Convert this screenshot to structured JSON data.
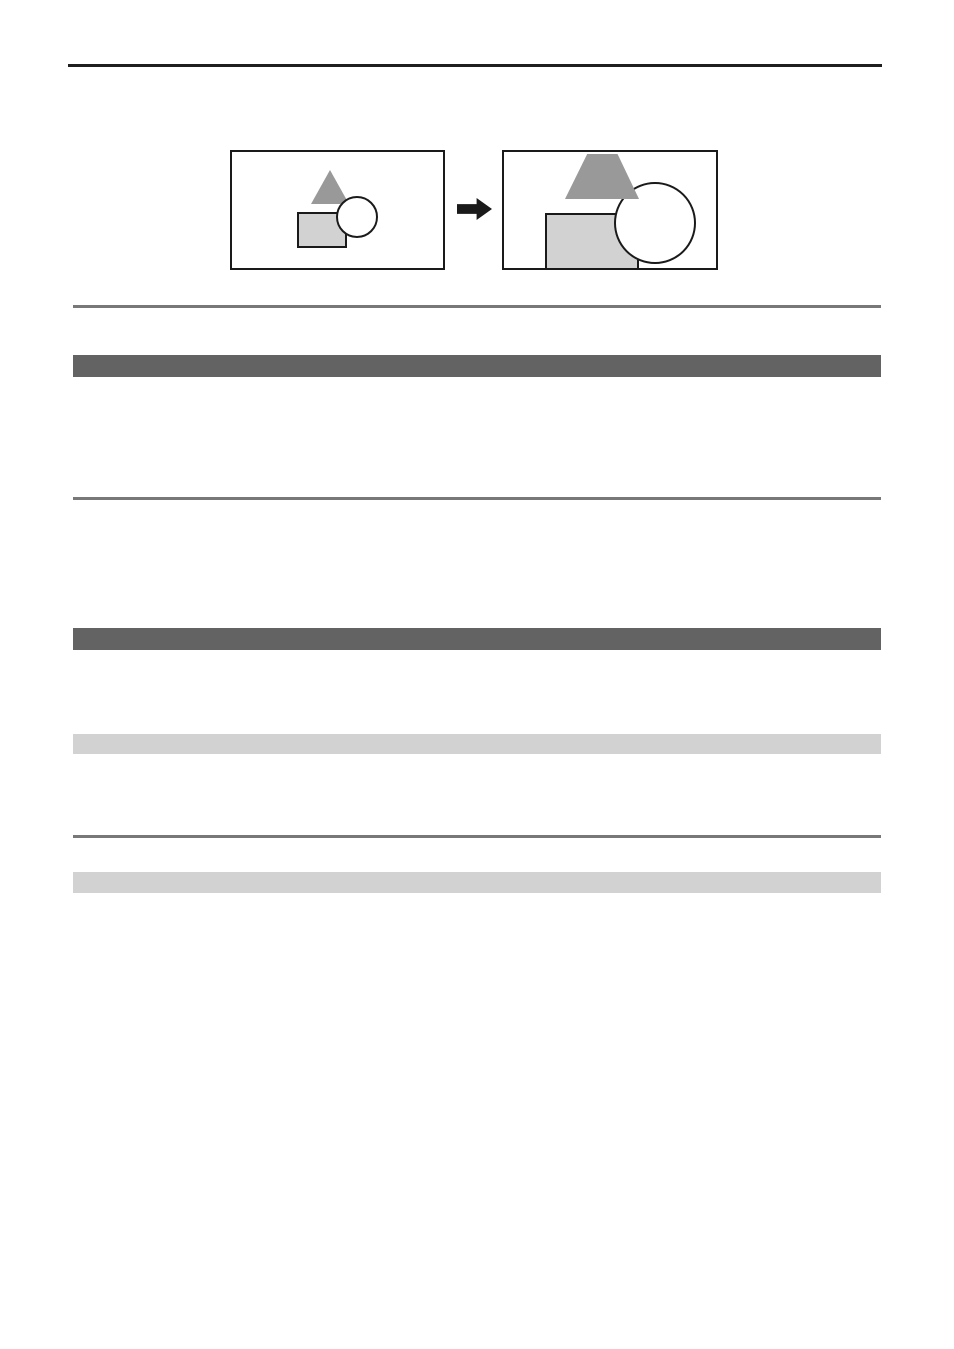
{
  "page": {
    "kind": "manual-page-template",
    "visible_text": [],
    "background": "#ffffff"
  },
  "colors": {
    "page_background": "#ffffff",
    "rule_black": "#1f1f1f",
    "rule_gray": "#787878",
    "header_bar_dark": "#636363",
    "header_bar_light": "#d2d2d2",
    "figure_frame_border": "#1a1a1a",
    "figure_shape_dark_gray": "#999999",
    "figure_shape_light_gray": "#d2d2d2",
    "figure_arrow": "#1a1a1a"
  },
  "figure": {
    "name": "enlargement-before-after-illustration",
    "before_frame": {
      "shapes": [
        "gray-triangle",
        "light-gray-rectangle",
        "white-circle"
      ]
    },
    "arrow_icon": "right-arrow-icon",
    "after_frame": {
      "shapes": [
        "gray-trapezoid-clipped-triangle",
        "light-gray-rectangle-clipped",
        "white-circle-enlarged"
      ]
    }
  },
  "sections": {
    "top_rule": "black-horizontal-rule",
    "divider_rules": [
      "gray-rule-1",
      "gray-rule-2",
      "gray-rule-3"
    ],
    "dark_header_bars": [
      "dark-gray-bar-1",
      "dark-gray-bar-2"
    ],
    "light_header_bars": [
      "light-gray-bar-1",
      "light-gray-bar-2"
    ]
  }
}
